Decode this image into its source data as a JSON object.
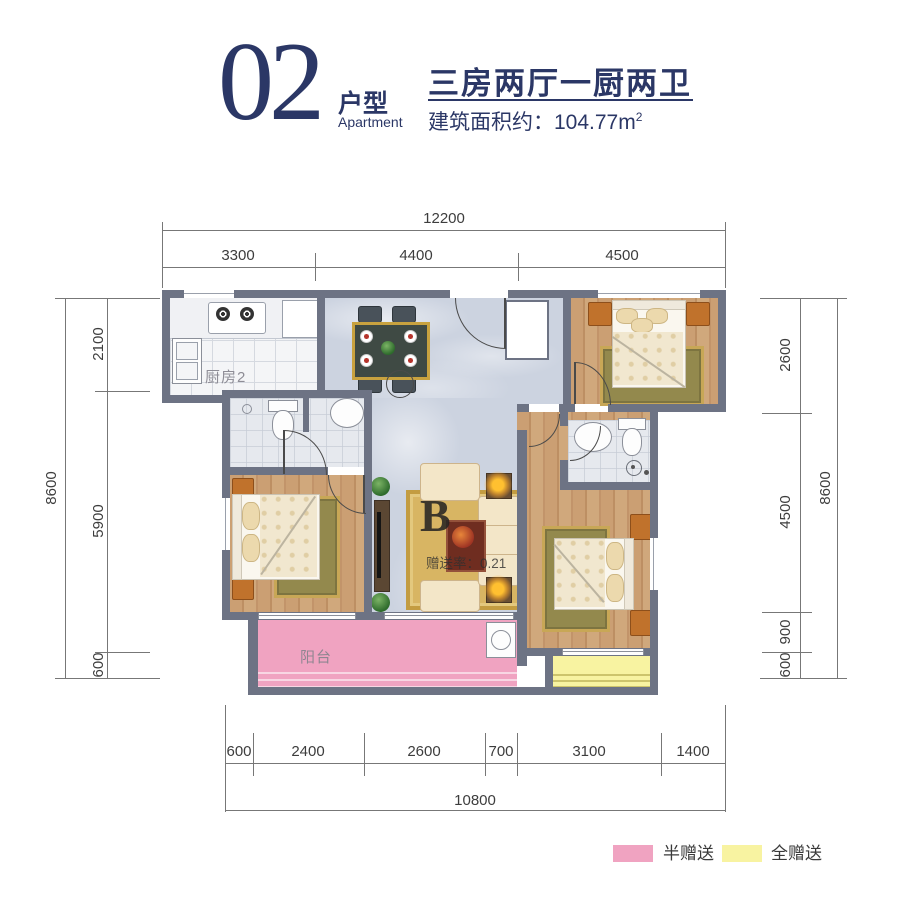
{
  "header": {
    "unit_number": "02",
    "unit_label": "户型",
    "unit_label_en": "Apartment",
    "headline": "三房两厅一厨两卫",
    "area_label": "建筑面积约：104.77m",
    "area_sup": "2"
  },
  "plan": {
    "rooms": {
      "kitchen": "厨房2",
      "balcony": "阳台"
    },
    "watermark": {
      "letter": "B",
      "ratio": "赠送率：0.21"
    }
  },
  "dimensions": {
    "top": {
      "total": "12200",
      "segments": [
        "3300",
        "4400",
        "4500"
      ]
    },
    "bottom": {
      "total": "10800",
      "segments": [
        "600",
        "2400",
        "2600",
        "700",
        "3100",
        "1400"
      ]
    },
    "left": {
      "total": "8600",
      "segments": [
        "2100",
        "5900",
        "600"
      ]
    },
    "right": {
      "total": "8600",
      "segments": [
        "2600",
        "4500",
        "900",
        "600"
      ]
    }
  },
  "legend": {
    "items": [
      {
        "label": "半赠送",
        "color": "#F0A3C1"
      },
      {
        "label": "全赠送",
        "color": "#F8F3A1"
      }
    ]
  },
  "colors": {
    "accent_navy": "#2B3766",
    "wall_gray": "#6D7384",
    "half_gift_pink": "#F0A3C1",
    "full_gift_yellow": "#F8F3A1",
    "wood_floor": "#C59A6F",
    "marble_floor": "#CDD3E0"
  }
}
